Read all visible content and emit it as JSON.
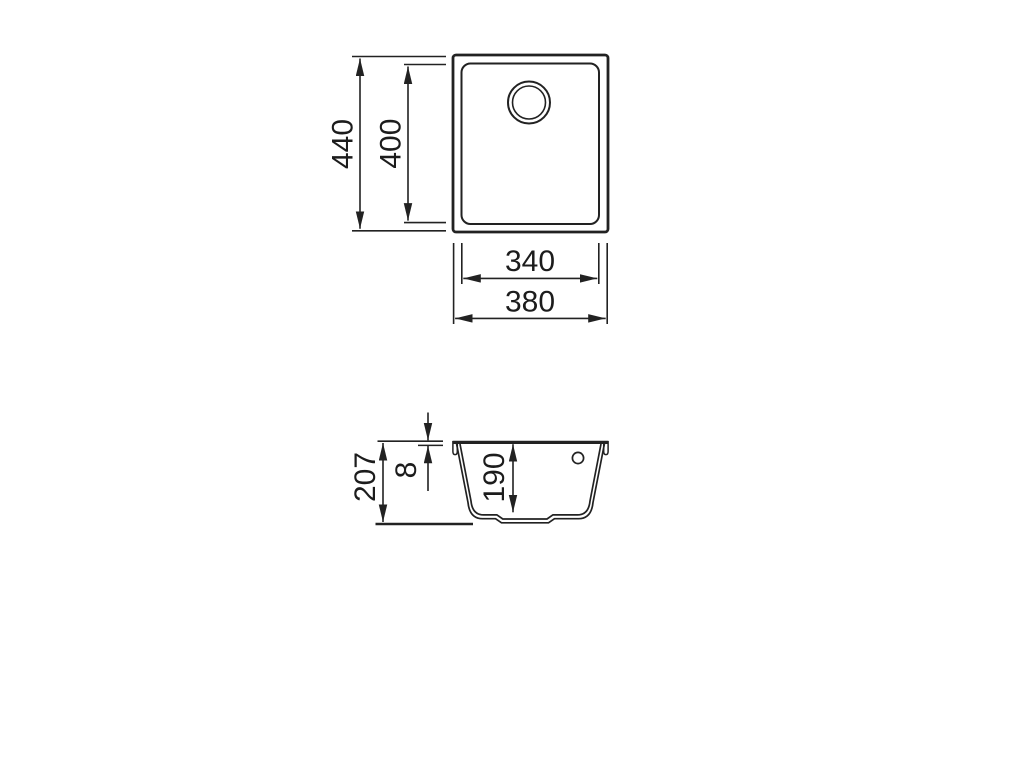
{
  "page": {
    "background_color": "#ffffff",
    "line_color": "#222222",
    "text_color": "#1c1c1c",
    "description": "Technical dimension drawing of an undermount sink: top plan view and front section view"
  },
  "views": {
    "top_view": {
      "name": "Top plan view of sink",
      "dimensions": {
        "overall_height": "440",
        "bowl_height": "400",
        "bowl_width": "340",
        "overall_width": "380"
      }
    },
    "section_view": {
      "name": "Front section view of sink",
      "dimensions": {
        "overall_depth": "207",
        "rim_thickness": "8",
        "bowl_depth": "190"
      }
    }
  }
}
